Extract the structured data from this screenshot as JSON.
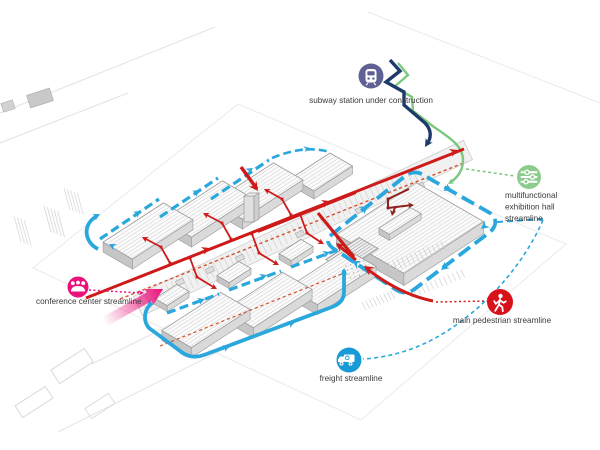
{
  "diagram": {
    "kind": "axonometric site circulation diagram",
    "colors": {
      "pedestrian_red": "#cf1a1a",
      "secondary_red": "#8e2020",
      "service_orange": "#d4502a",
      "freight_blue": "#2aa7dc",
      "exhibition_green": "#7cc87e",
      "subway_navy": "#1d3a6a",
      "conference_pink": "#e9127c"
    }
  },
  "legend": {
    "subway": {
      "label": "subway station under construction",
      "icon": "train-icon",
      "color": "#5f6094"
    },
    "exhibition": {
      "line1": "multifunctional",
      "line2": "exhibition hall",
      "line3": "streamline",
      "icon": "sliders-icon",
      "color": "#8ccc8e"
    },
    "conference": {
      "label": "conference center streamline",
      "icon": "people-icon",
      "color": "#e9127c"
    },
    "pedestrian": {
      "label": "main pedestrian streamline",
      "icon": "walking-person-icon",
      "color": "#d8121a"
    },
    "freight": {
      "label": "freight streamline",
      "icon": "truck-icon",
      "color": "#189ad6"
    }
  }
}
